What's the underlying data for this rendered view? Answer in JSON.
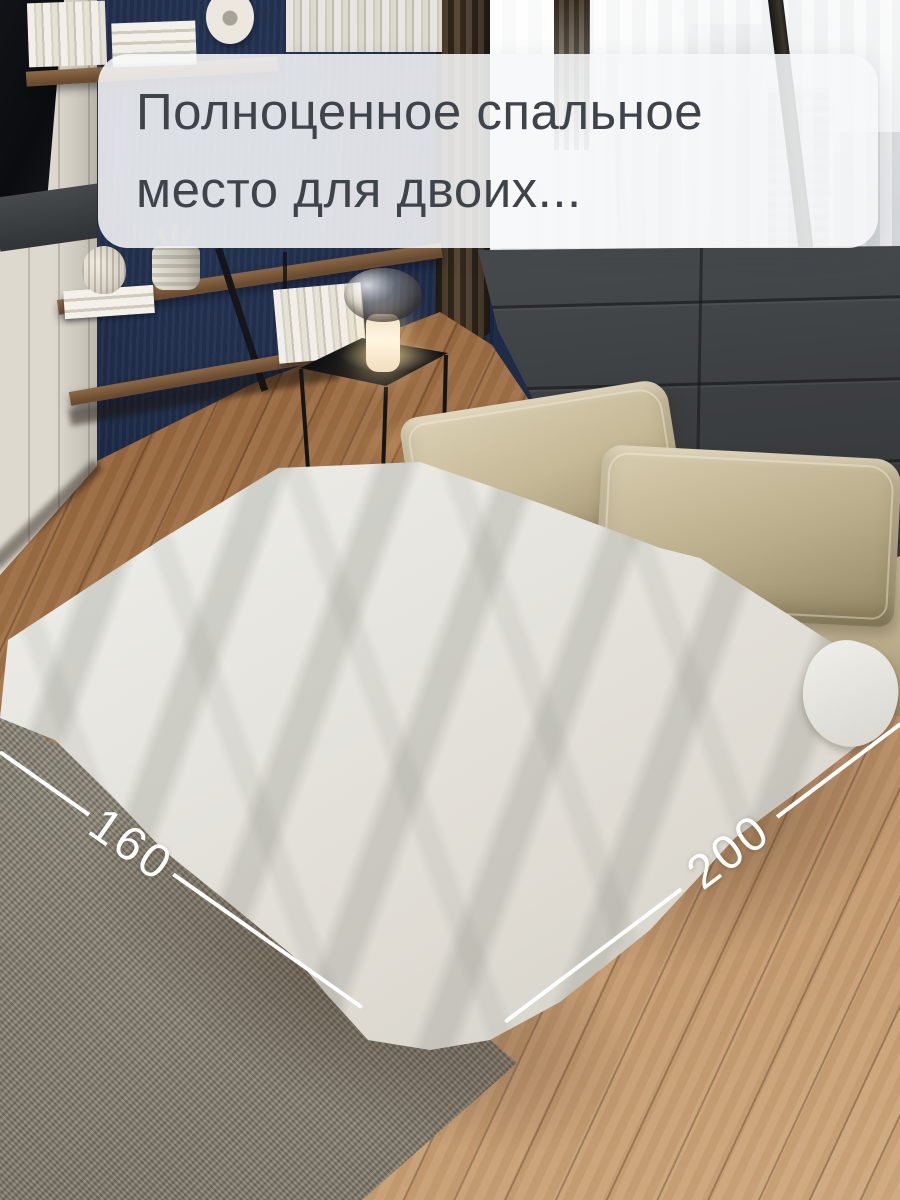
{
  "caption": {
    "line1": "Полноценное спальное",
    "line2": "место для двоих...",
    "text_color": "#3f444b",
    "bg": "rgba(246,247,248,0.88)"
  },
  "dimensions": {
    "width": {
      "label": "160"
    },
    "length": {
      "label": "200"
    },
    "line_color": "#ffffff"
  },
  "palette": {
    "wall_navy": "#1f2d4a",
    "headboard_charcoal": "#3a3d40",
    "pillow_beige": "#c5b897",
    "sheet_offwhite": "#ebebe7",
    "rug_gray": "#857e70",
    "floor_wood_dark": "#744624",
    "floor_wood_light": "#cfa87d",
    "shelf_wood": "#7a5a3b",
    "table_black": "#141517",
    "curtain_brown": "#52402b",
    "lamp_glow": "#fff6e0",
    "skyline_gray": "#a9b0b4"
  }
}
